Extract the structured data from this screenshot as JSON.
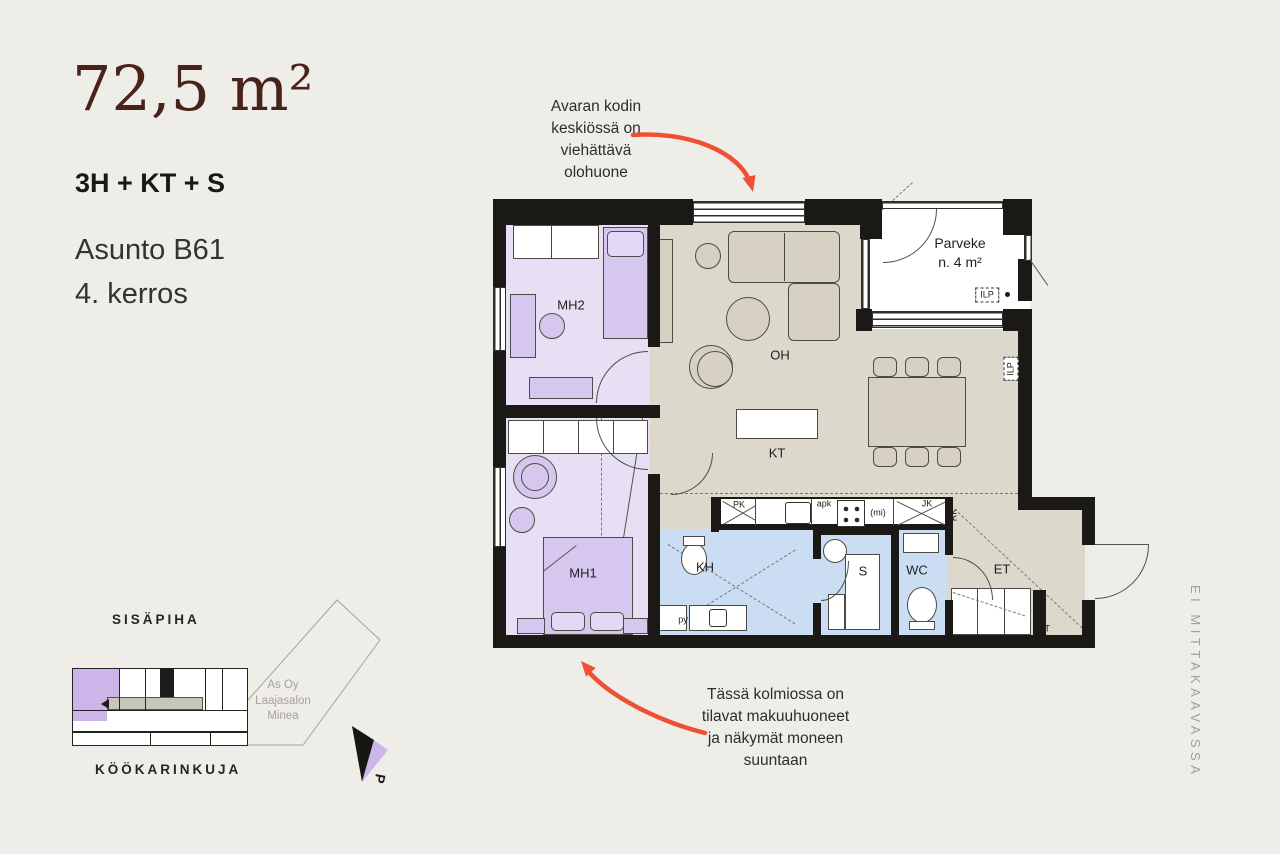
{
  "header": {
    "area": "72,5 m²",
    "layout": "3H + KT + S",
    "apartment": "Asunto B61",
    "floor": "4. kerros"
  },
  "annotations": {
    "top_lines": [
      "Avaran kodin",
      "keskiössä on",
      "viehättävä",
      "olohuone"
    ],
    "bottom_lines": [
      "Tässä kolmiossa on",
      "tilavat makuuhuoneet",
      "ja näkymät moneen",
      "suuntaan"
    ]
  },
  "plan": {
    "rooms": {
      "mh2": "MH2",
      "mh1": "MH1",
      "oh": "OH",
      "kt": "KT",
      "kh": "KH",
      "sauna": "S",
      "wc": "WC",
      "et": "ET",
      "parveke": "Parveke",
      "parveke_area": "n. 4 m²"
    },
    "labels": {
      "pk": "PK",
      "apk": "apk",
      "mi": "(mi)",
      "jk": "JK",
      "rk": "RK",
      "jt": "JT",
      "py": "py",
      "ilp": "ILP"
    }
  },
  "siteplan": {
    "courtyard": "SISÄPIHA",
    "street": "KÖÖKARINKUJA",
    "company_lines": [
      "As Oy",
      "Laajasalon",
      "Minea"
    ],
    "compass": "P"
  },
  "scale_note": "EI MITTAKAAVASSA",
  "colors": {
    "accent_red": "#F04F33",
    "brand_brown": "#49221A",
    "bedroom_purple": "#E7DFF3",
    "wetroom_blue": "#CBDDF2",
    "living_beige": "#DCD8CB"
  }
}
